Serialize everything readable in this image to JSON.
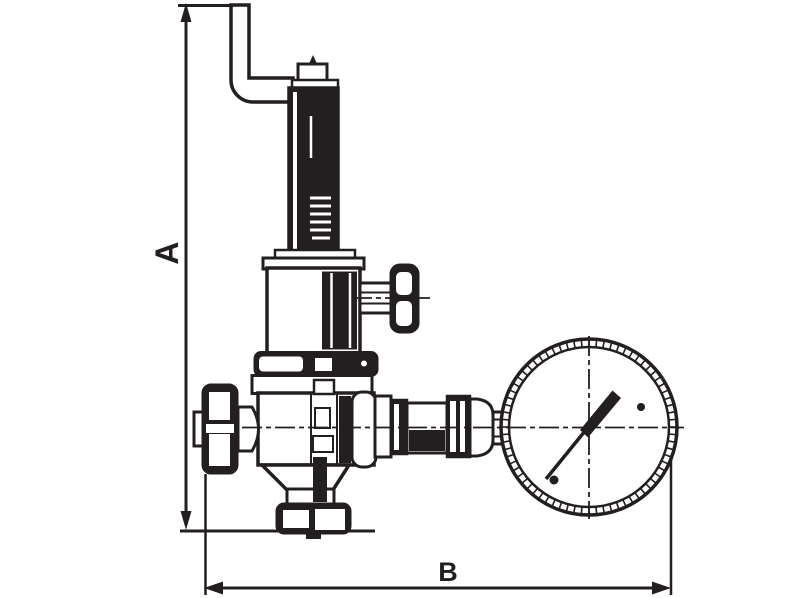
{
  "diagram": {
    "type": "technical-line-drawing",
    "subject": "Pressure reducing valve with pressure gauge - dimensioned outline drawing",
    "colors": {
      "ink": "#231f20",
      "background": "#ffffff"
    },
    "dimension_a": {
      "label": "A",
      "orientation": "vertical",
      "side": "left"
    },
    "dimension_b": {
      "label": "B",
      "orientation": "horizontal",
      "side": "bottom"
    },
    "gauge": {
      "cx": 589,
      "cy": 427,
      "r_outer": 88,
      "r_inner": 80,
      "tick_count": 72
    },
    "components": [
      "vent-pipe-elbow",
      "adjuster-cap",
      "spring-tube",
      "spring-housing",
      "side-tap-valve",
      "bonnet-flange",
      "valve-body",
      "inlet-coupling",
      "bottom-outlet-union",
      "outlet-fittings",
      "pressure-gauge"
    ]
  }
}
